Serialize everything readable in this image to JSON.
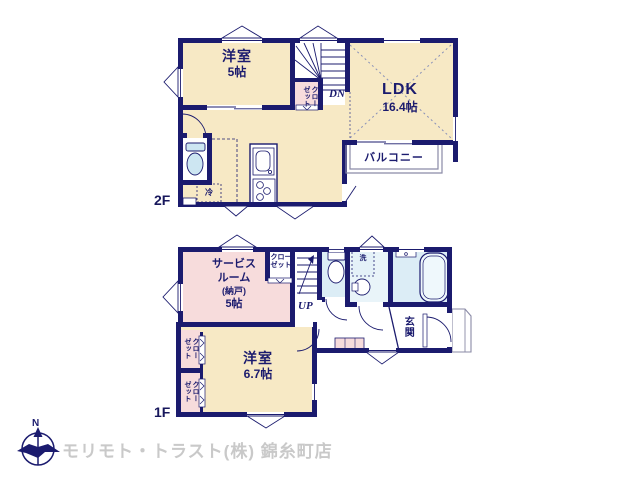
{
  "floor2": {
    "label": "2F",
    "room1_name": "洋室",
    "room1_size": "5帖",
    "ldk_name": "LDK",
    "ldk_size": "16.4帖",
    "balcony": "バルコニー",
    "closet": "クローゼット",
    "stairs_down": "DN",
    "fridge": "冷"
  },
  "floor1": {
    "label": "1F",
    "service_l1": "サービス",
    "service_l2": "ルーム",
    "service_l3": "(納戸)",
    "service_l4": "5帖",
    "closet_top_l1": "クロー",
    "closet_top_l2": "ゼット",
    "room_name": "洋室",
    "room_size": "6.7帖",
    "closet1": "クローゼット",
    "closet2": "クローゼット",
    "stairs_up": "UP",
    "wash": "洗",
    "entrance": "玄関"
  },
  "footer": {
    "company": "モリモト・トラスト(株) 錦糸町店",
    "compass_north": "N"
  },
  "colors": {
    "wall_navy": "#1b1b6e",
    "room_cream": "#f7e9c5",
    "room_pink": "#f7dcdc",
    "wet_blue": "#dcedf6",
    "fixture_blue": "#cde6f2",
    "watermark_gray": "#c9c9c9"
  }
}
